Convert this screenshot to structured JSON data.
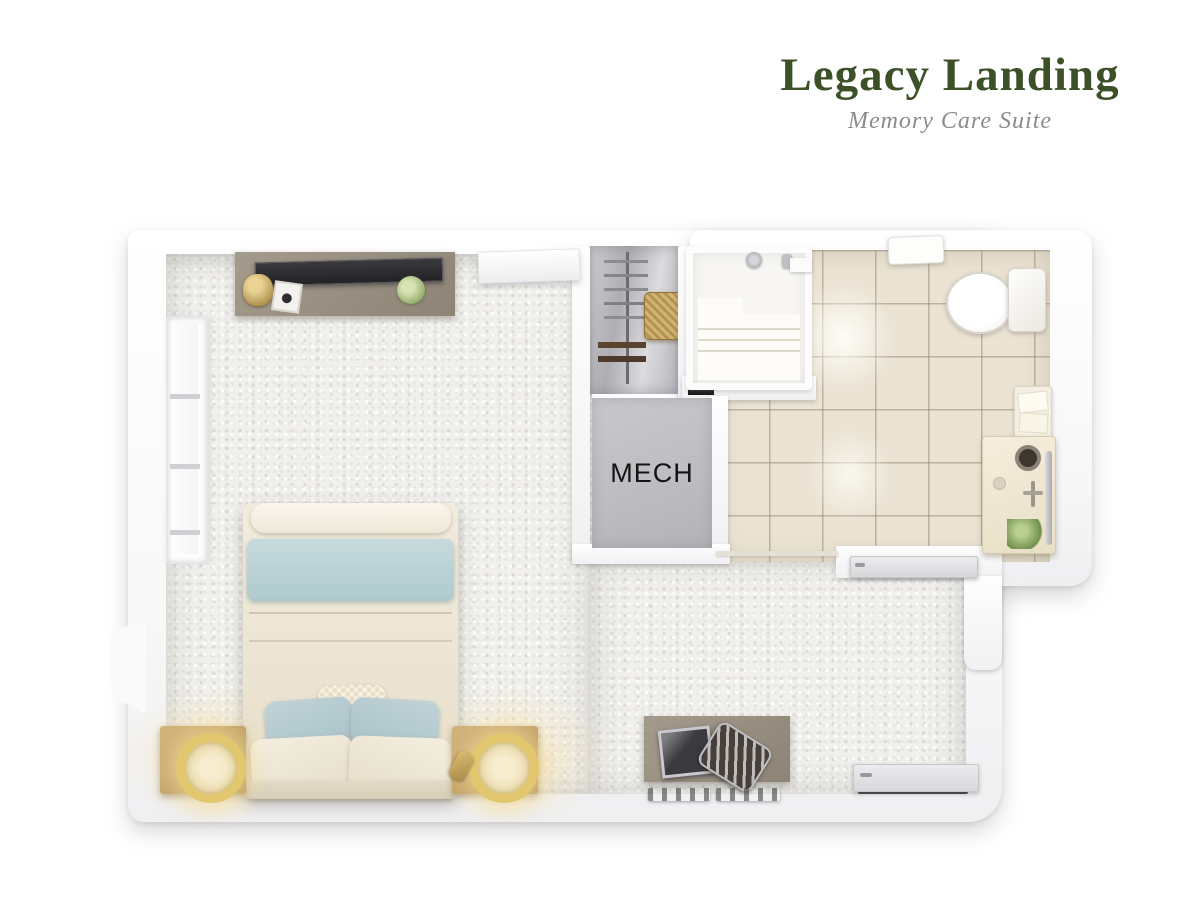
{
  "header": {
    "title": "Legacy Landing",
    "subtitle": "Memory Care Suite"
  },
  "floorplan": {
    "room_labels": {
      "mech": "MECH"
    },
    "rooms": [
      "bedroom-living-area",
      "closet",
      "mechanical-room",
      "walk-in-shower",
      "bathroom",
      "entry"
    ],
    "furniture": [
      "dresser",
      "tv",
      "wall-shelf",
      "window",
      "bed",
      "throw-blanket",
      "accent-pillow",
      "pillows",
      "nightstand-left",
      "nightstand-right",
      "table-lamp",
      "desk",
      "desk-chair",
      "laptop",
      "closet-rod",
      "hangers",
      "laundry-basket",
      "shower-bench",
      "shower-head",
      "toilet",
      "vanity-sink",
      "towel-shelf",
      "plant",
      "bathroom-door",
      "entry-door"
    ],
    "colors": {
      "title_green": "#3d5128",
      "subtitle_gray": "#8c8c8c",
      "wall_white": "#fbfbfc",
      "carpet": "#f1f0ed",
      "tile": "#ebe3d3",
      "tile_grout": "#a79d8b",
      "mech_floor": "#bcbabf",
      "mech_text": "#141414",
      "wood_taupe": "#968d80",
      "nightstand_oak": "#c5a672",
      "lamp_gold": "#dfc06a",
      "blanket_blue": "#bdd3d6",
      "bedding_cream": "#ece4d2",
      "door_gray": "#d9dadc"
    }
  }
}
